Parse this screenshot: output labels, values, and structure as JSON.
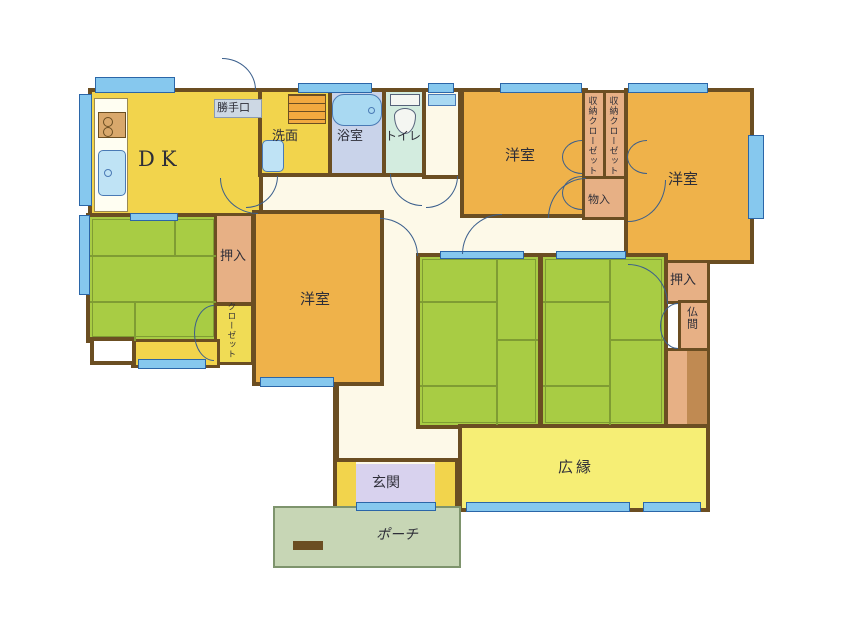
{
  "rooms": {
    "dk": {
      "label": "DK"
    },
    "katteguchi": {
      "label": "勝手口"
    },
    "senmen": {
      "label": "洗面"
    },
    "yokushitsu": {
      "label": "浴室"
    },
    "toilet": {
      "label": "トイレ"
    },
    "yoshitsu_top_left": {
      "label": "洋室"
    },
    "yoshitsu_top_right": {
      "label": "洋室"
    },
    "yoshitsu_center": {
      "label": "洋室"
    },
    "shuno_closet_1": {
      "label": "収納クローゼット"
    },
    "shuno_closet_2": {
      "label": "収納クローゼット"
    },
    "monoire": {
      "label": "物入"
    },
    "oshiire_left": {
      "label": "押入"
    },
    "closet": {
      "label": "クローゼット"
    },
    "oshiire_right": {
      "label": "押入"
    },
    "butsuma": {
      "label": "仏間"
    },
    "hiroen": {
      "label": "広縁"
    },
    "genkan": {
      "label": "玄関"
    },
    "porch": {
      "label": "ポーチ"
    }
  },
  "icons": {
    "stove": "stove-icon",
    "kitchen_sink": "kitchen-sink-icon",
    "washbasin": "washbasin-icon",
    "washer": "washing-machine-icon",
    "bathtub": "bathtub-icon",
    "toilet": "toilet-icon",
    "counter": "counter-icon"
  },
  "colors": {
    "wall": "#6b4e22",
    "yellow": "#f2d44c",
    "light_yellow": "#f6ee75",
    "orange": "#efb24a",
    "green": "#a8cc44",
    "tatami_line": "#7f9c33",
    "tan": "#e7b085",
    "tan_dark": "#c08a52",
    "closet_yellow": "#f0dc55",
    "lavender": "#d8d2ee",
    "porch": "#c7d6b5",
    "bath": "#c9d3ea",
    "toilet_room": "#d3ecdf",
    "cream": "#fdf9e8",
    "window_fill": "#86c8ee",
    "window_stroke": "#2b66a8",
    "door_line": "#3a5e8c",
    "label_grey": "#cdd8e4"
  }
}
